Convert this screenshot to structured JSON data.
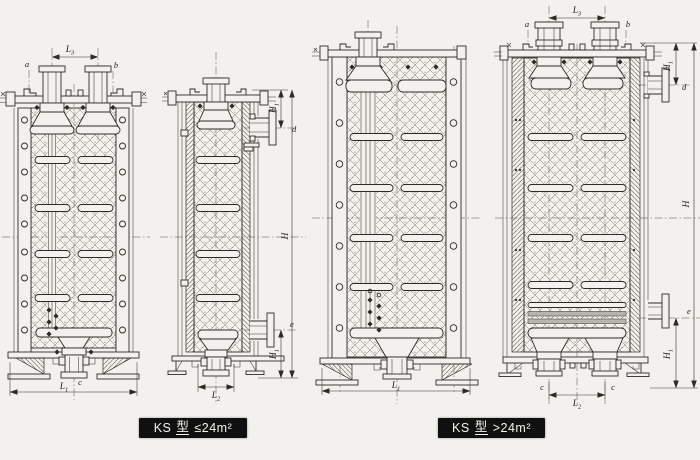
{
  "captions": {
    "small": {
      "model": "KS",
      "type_char": "型",
      "condition": "≤24m²"
    },
    "large": {
      "model": "KS",
      "type_char": "型",
      "condition": ">24m²"
    }
  },
  "labels": {
    "a": "a",
    "b": "b",
    "c": "c",
    "d": "d",
    "e": "e",
    "H": "H",
    "H1": {
      "base": "H",
      "sub": "1"
    },
    "L1": {
      "base": "L",
      "sub": "1"
    },
    "L2": {
      "base": "L",
      "sub": "2"
    },
    "L3": {
      "base": "L",
      "sub": "3"
    }
  },
  "colors": {
    "paper": "#f3f1ed",
    "ink": "#2e2b27",
    "caption_bg": "#101010",
    "caption_text": "#f4f4ee"
  }
}
